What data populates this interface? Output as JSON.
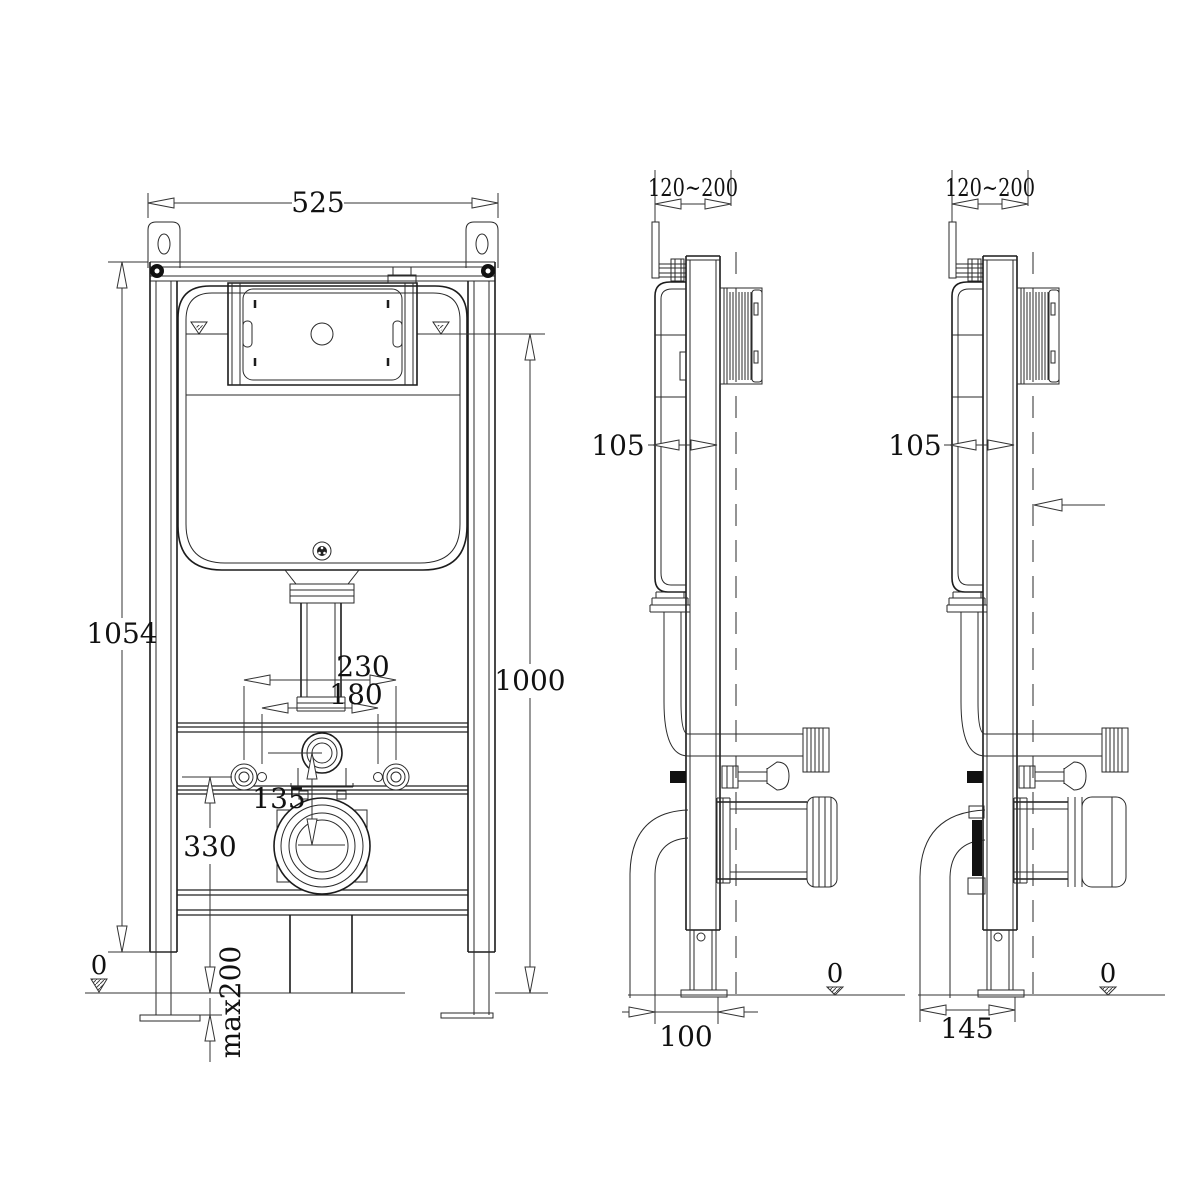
{
  "drawing": {
    "views": {
      "front": {
        "dims": {
          "overall_width": "525",
          "frame_height": "1054",
          "mounting_height": "1000",
          "fixing_spacing_outer": "230",
          "fixing_spacing_inner": "180",
          "outlet_offset": "135",
          "fixing_height": "330",
          "floor_level": "0",
          "foot_adjustment": "max200"
        }
      },
      "side_left": {
        "dims": {
          "flush_plate_range": "120~200",
          "frame_depth": "105",
          "base_depth": "100",
          "floor_level": "0"
        }
      },
      "side_right": {
        "dims": {
          "flush_plate_range": "120~200",
          "frame_depth": "105",
          "base_depth": "145",
          "floor_level": "0"
        }
      }
    }
  }
}
